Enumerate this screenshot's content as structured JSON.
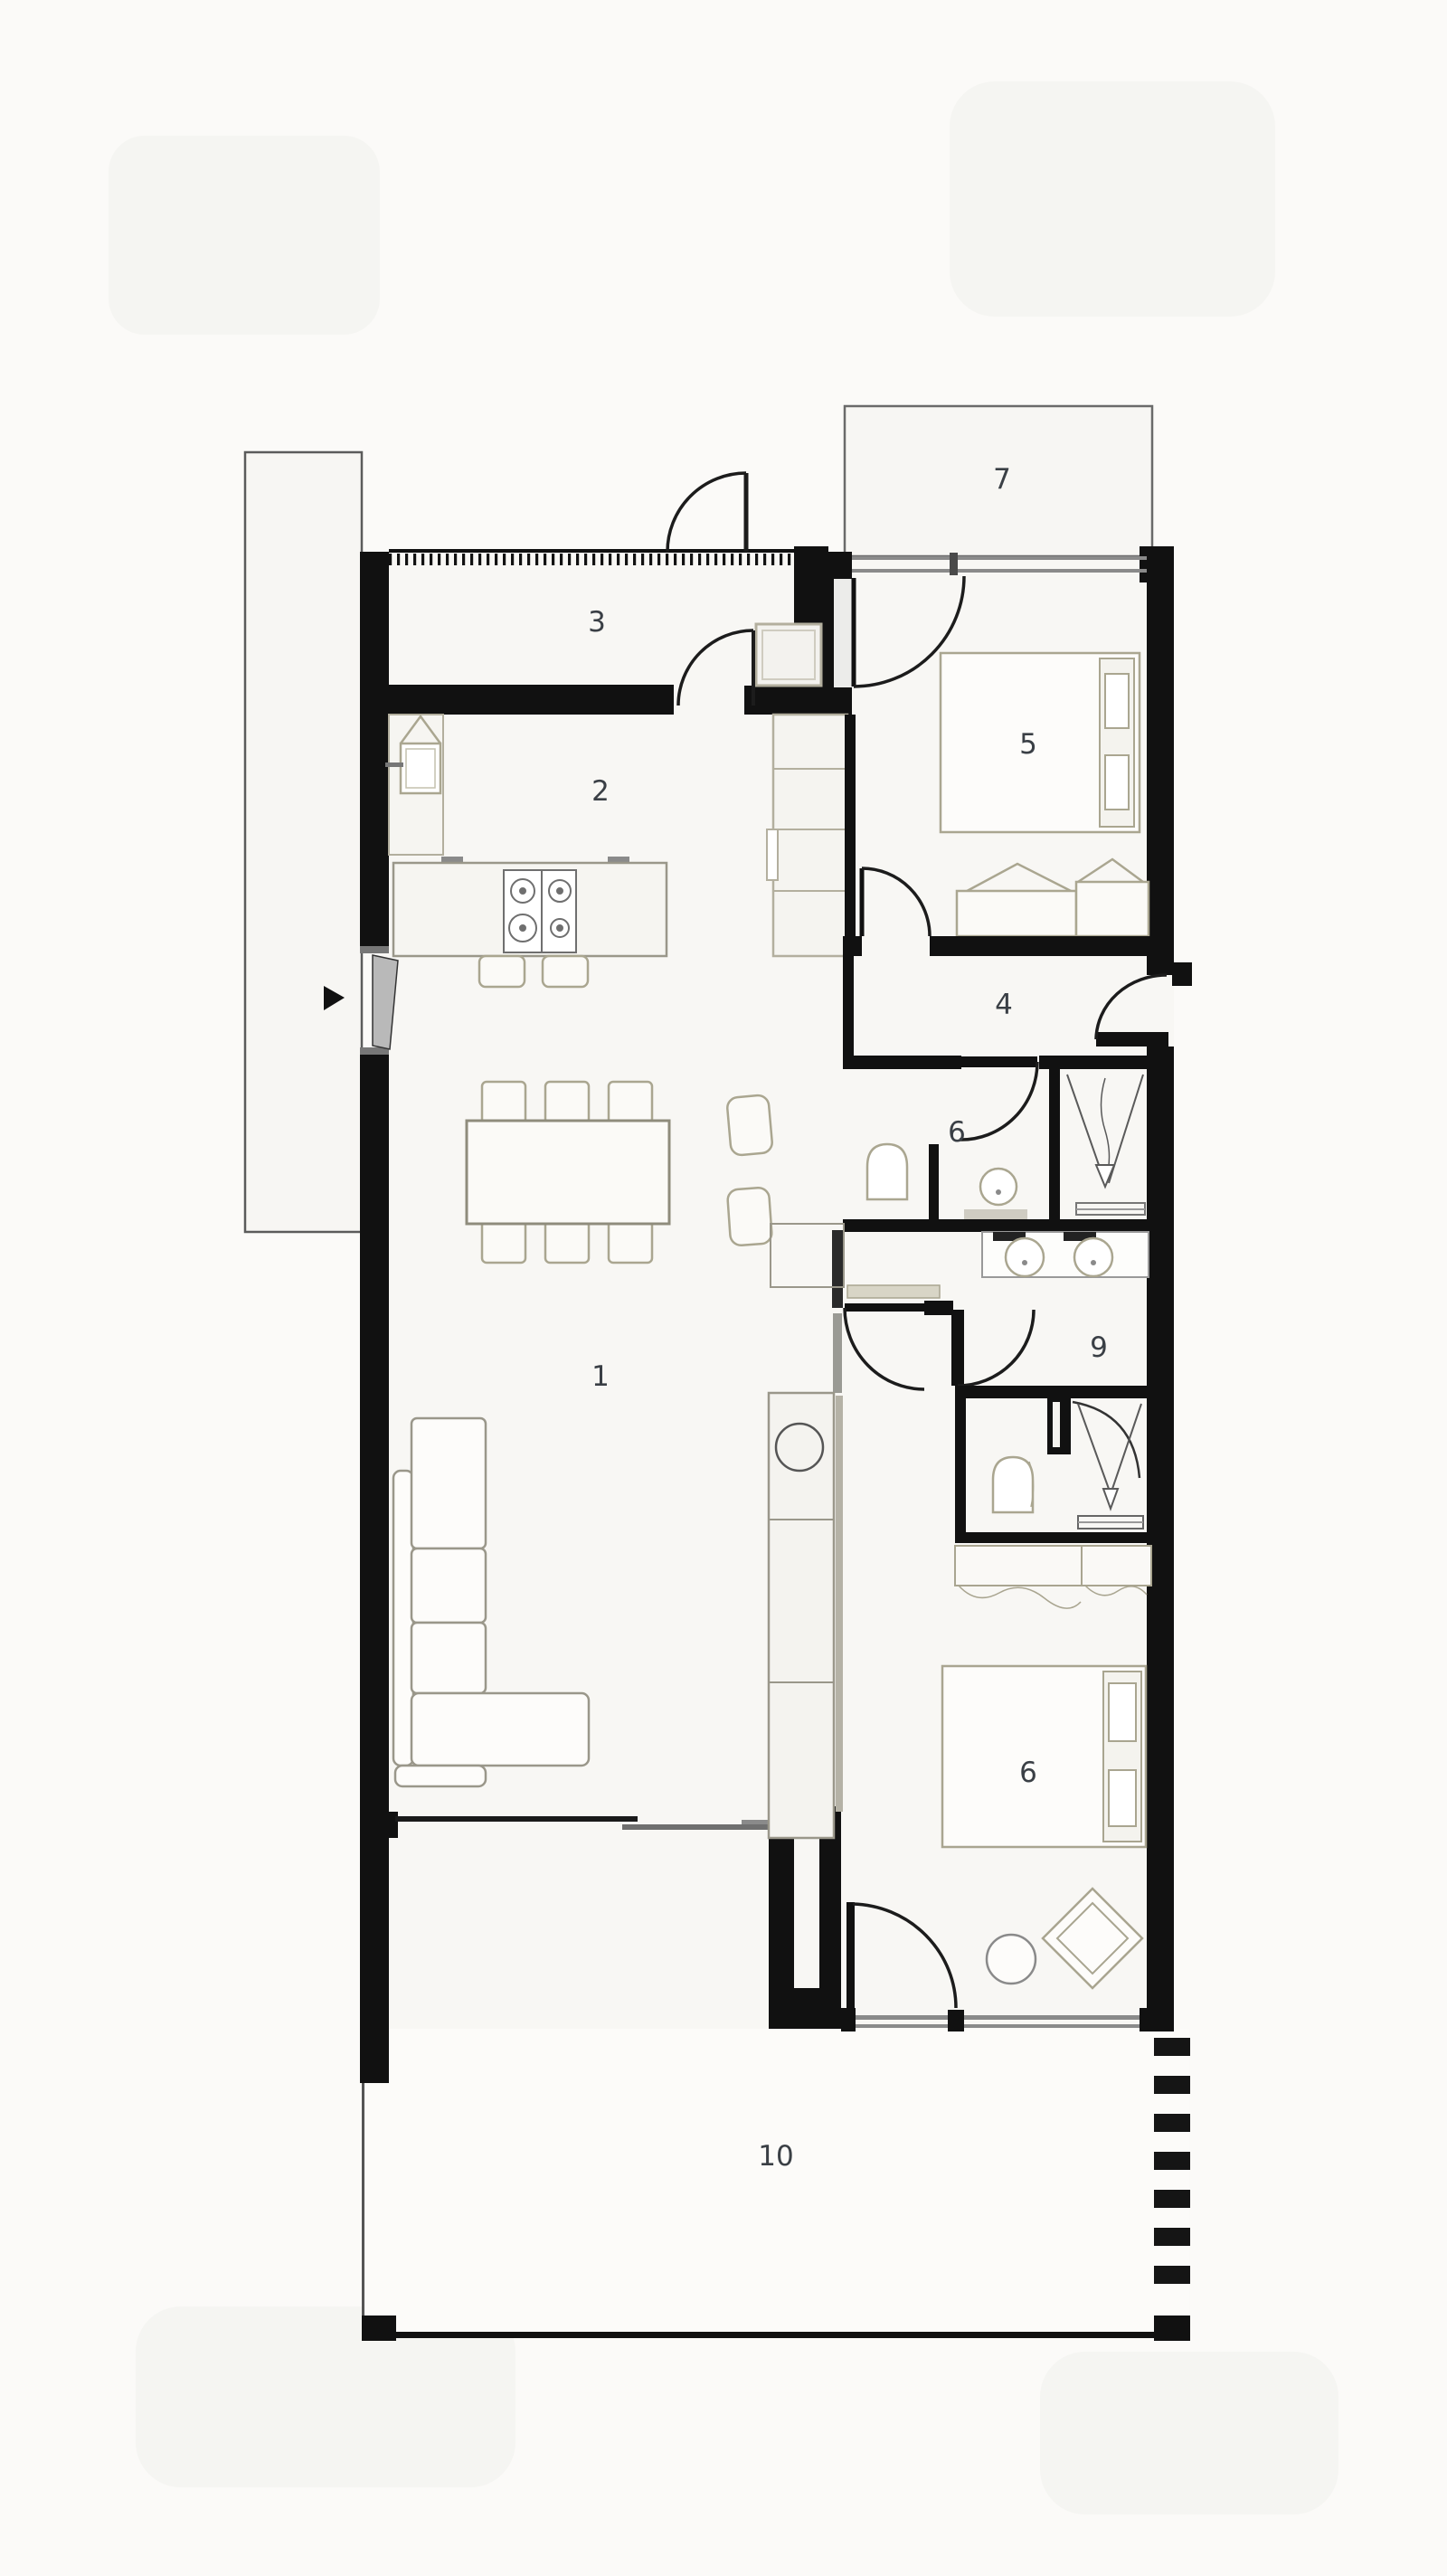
{
  "title": "apartment-floor-plan",
  "colors": {
    "background": "#fbfaf8",
    "floor": "#f8f7f4",
    "wall": "#111111",
    "furniture_outline": "#9a978a",
    "tan_outline": "#aaa690",
    "window_line": "#8a8a8a",
    "door_line": "#1c1c1c",
    "label_color": "#3a3f45"
  },
  "rooms": [
    {
      "label": "1"
    },
    {
      "label": "2"
    },
    {
      "label": "3"
    },
    {
      "label": "4"
    },
    {
      "label": "5"
    },
    {
      "label": "6"
    },
    {
      "label": "7"
    },
    {
      "label": "9"
    },
    {
      "label": "6"
    },
    {
      "label": "10"
    }
  ]
}
